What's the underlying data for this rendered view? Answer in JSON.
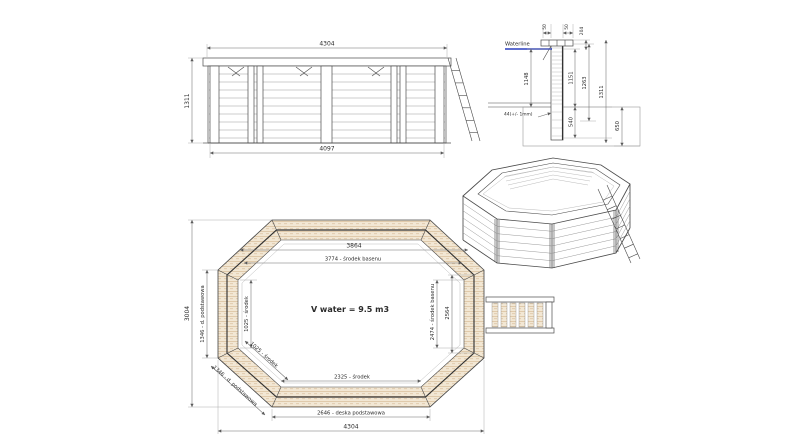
{
  "colors": {
    "background": "#ffffff",
    "line": "#4a4a4a",
    "dimension_line": "#6e6e6e",
    "wood_fill": "#f2e7d4",
    "wood_stripe": "#d9bf9e",
    "waterline": "#2a3fbf",
    "text": "#2b2b2b"
  },
  "elevation": {
    "dim_width_top": "4304",
    "dim_height_left": "1311",
    "dim_width_bottom": "4097"
  },
  "section": {
    "waterline_label": "Waterline",
    "dim_cap_left": "50",
    "dim_cap_right": "50",
    "dim_top_204": "204",
    "dim_1148": "1148",
    "note_44": "44(+/- 1mm)",
    "dim_1151": "1151",
    "dim_540": "540",
    "dim_1263": "1263",
    "dim_1311": "1311",
    "dim_650": "650"
  },
  "plan": {
    "dim_3864": "3864",
    "dim_3774": "3774 - środek basenu",
    "volume": "V water = 9.5 m3",
    "dim_2325": "2325 - środek",
    "dim_2646": "2646 - deska podstawowa",
    "dim_4304": "4304",
    "dim_3004": "3004",
    "dim_1346_side": "1346 - d. podstawowa",
    "dim_1025_side": "1025 - środek",
    "dim_1025_diag": "1025 - środek",
    "dim_1346_diag": "1346 - d. podstawowa",
    "dim_2474": "2474 - środek basenu",
    "dim_2564": "2564"
  }
}
